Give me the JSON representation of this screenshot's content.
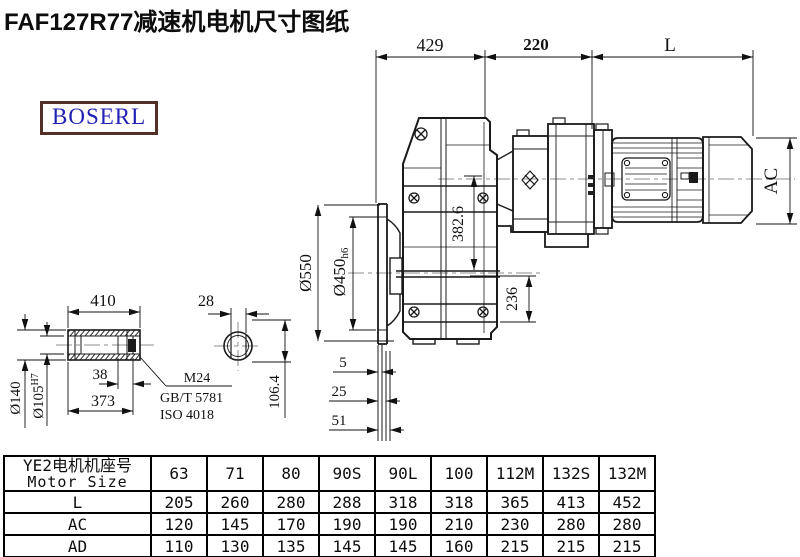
{
  "title": "FAF127R77减速机电机尺寸图纸",
  "logo": "BOSERL",
  "drawing": {
    "dims": {
      "top1": "429",
      "top2": "220",
      "top3": "L",
      "ac": "AC",
      "flange_od": "Ø550",
      "flange_spigot": "Ø450",
      "flange_spigot_tol": "h6",
      "axis_dist": "382.6",
      "base_height": "236",
      "off1": "5",
      "off2": "25",
      "off3": "51",
      "shaft_len": "410",
      "key_width": "28",
      "shaft_od": "Ø140",
      "bore": "Ø105",
      "bore_tol": "H7",
      "end_step": "38",
      "shaft_body": "373",
      "key_height": "106.4",
      "thread": "M24",
      "thread_std1": "GB/T 5781",
      "thread_std2": "ISO 4018"
    },
    "colors": {
      "line": "#1a1a1a",
      "centerline": "#8d8d8d",
      "logo_text": "#2121b4",
      "logo_border": "#533027"
    }
  },
  "table": {
    "header_cn": "YE2电机机座号",
    "header_en": "Motor Size",
    "sizes": [
      "63",
      "71",
      "80",
      "90S",
      "90L",
      "100",
      "112M",
      "132S",
      "132M"
    ],
    "rows": [
      {
        "label": "L",
        "values": [
          "205",
          "260",
          "280",
          "288",
          "318",
          "318",
          "365",
          "413",
          "452"
        ]
      },
      {
        "label": "AC",
        "values": [
          "120",
          "145",
          "170",
          "190",
          "190",
          "210",
          "230",
          "280",
          "280"
        ]
      },
      {
        "label": "AD",
        "values": [
          "110",
          "130",
          "135",
          "145",
          "145",
          "160",
          "215",
          "215",
          "215"
        ]
      }
    ]
  }
}
